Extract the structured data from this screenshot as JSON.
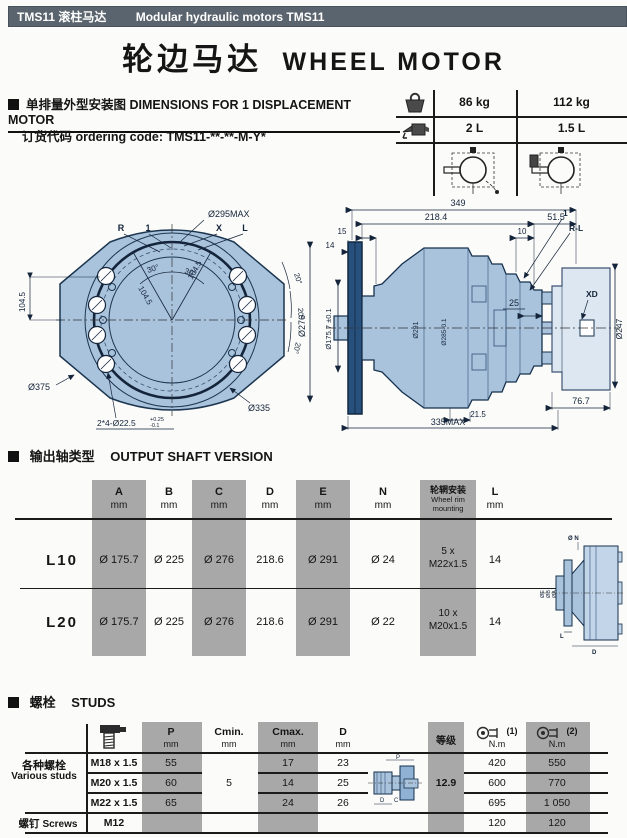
{
  "topbar": {
    "left": "TMS11 滚柱马达",
    "right": "Modular hydraulic motors TMS11"
  },
  "title": {
    "cn": "轮边马达",
    "en": "WHEEL MOTOR"
  },
  "dims_section": {
    "heading": "单排量外型安装图 DIMENSIONS FOR 1 DISPLACEMENT MOTOR",
    "ordering": "订货代码 ordering code: TMS11-**-**-M-Y*",
    "weights": [
      "86 kg",
      "112 kg"
    ],
    "oil": [
      "2 L",
      "1.5 L"
    ]
  },
  "front_view": {
    "d_pilot": "Ø295MAX",
    "port_r": "R",
    "port_1": "1",
    "port_x": "X",
    "port_l": "L",
    "ang30_a": "30°",
    "ang30_b": "30°",
    "r104_left": "104.5",
    "r104_d1": "104.5",
    "r104_d2": "104.5",
    "d375": "Ø375",
    "d335": "Ø335",
    "holes": "2*4-Ø22.5",
    "holes_tol_up": "+0.25",
    "holes_tol_dn": "-0.1",
    "ang20_a": "20°",
    "ang20_b": "20°",
    "ang20_c": "20°",
    "d276": "Ø276"
  },
  "side_view": {
    "len349": "349",
    "len218": "218.4",
    "len51": "51.5",
    "len10": "10",
    "len15": "15",
    "len14": "14",
    "lead1": "1",
    "leadrl": "R-L",
    "len25": "25",
    "xd": "XD",
    "d247": "Ø247",
    "d175": "Ø175.7 ±0.1",
    "d291": "Ø291",
    "d285": "Ø285-0.1",
    "len21": "21.5",
    "len76": "76.7",
    "len335": "335MAX"
  },
  "shaft_section": {
    "heading_cn": "输出轴类型",
    "heading_en": "OUTPUT SHAFT VERSION",
    "cols": [
      {
        "label": "A",
        "unit": "mm"
      },
      {
        "label": "B",
        "unit": "mm"
      },
      {
        "label": "C",
        "unit": "mm"
      },
      {
        "label": "D",
        "unit": "mm"
      },
      {
        "label": "E",
        "unit": "mm"
      },
      {
        "label": "N",
        "unit": "mm"
      },
      {
        "label": "轮辋安装",
        "sub1": "Wheel rim",
        "sub2": "mounting"
      },
      {
        "label": "L",
        "unit": "mm"
      }
    ],
    "rows": [
      {
        "name": "L10",
        "a": "Ø 175.7",
        "b": "Ø 225",
        "c": "Ø 276",
        "d": "218.6",
        "e": "Ø 291",
        "n": "Ø 24",
        "rim1": "5 x",
        "rim2": "M22x1.5",
        "l": "14"
      },
      {
        "name": "L20",
        "a": "Ø 175.7",
        "b": "Ø 225",
        "c": "Ø 276",
        "d": "218.6",
        "e": "Ø 291",
        "n": "Ø 22",
        "rim1": "10 x",
        "rim2": "M20x1.5",
        "l": "14"
      }
    ],
    "mini_labels": {
      "n": "Ø N",
      "e": "ØE",
      "b": "ØB",
      "a": "ØA",
      "l": "L",
      "d": "D"
    }
  },
  "studs_section": {
    "heading_cn": "螺栓",
    "heading_en": "STUDS",
    "head": {
      "p": "P",
      "cmin": "Cmin.",
      "cmax": "Cmax.",
      "d": "D",
      "mm": "mm",
      "grade": "等级",
      "t1": "(1)",
      "t2": "(2)",
      "nm": "N.m"
    },
    "group1_cn": "各种螺栓",
    "group1_en": "Various studs",
    "group2_cn": "螺钉",
    "group2_en": "Screws",
    "cmin_val": "5",
    "grade_val": "12.9",
    "rows": [
      {
        "size": "M18 x 1.5",
        "p": "55",
        "cmax": "17",
        "d": "23",
        "t1": "420",
        "t2": "550"
      },
      {
        "size": "M20 x 1.5",
        "p": "60",
        "cmax": "14",
        "d": "25",
        "t1": "600",
        "t2": "770"
      },
      {
        "size": "M22 x 1.5",
        "p": "65",
        "cmax": "24",
        "d": "26",
        "t1": "695",
        "t2": "1 050"
      }
    ],
    "screws_row": {
      "size": "M12",
      "t1": "120",
      "t2": "120"
    },
    "mini_labels": {
      "p": "P",
      "d": "D",
      "c": "C"
    }
  },
  "colors": {
    "bar": "#5a646e",
    "body_fill": "#a9c3dc",
    "flange_dark": "#28507d",
    "band": "#a8a8a8"
  }
}
